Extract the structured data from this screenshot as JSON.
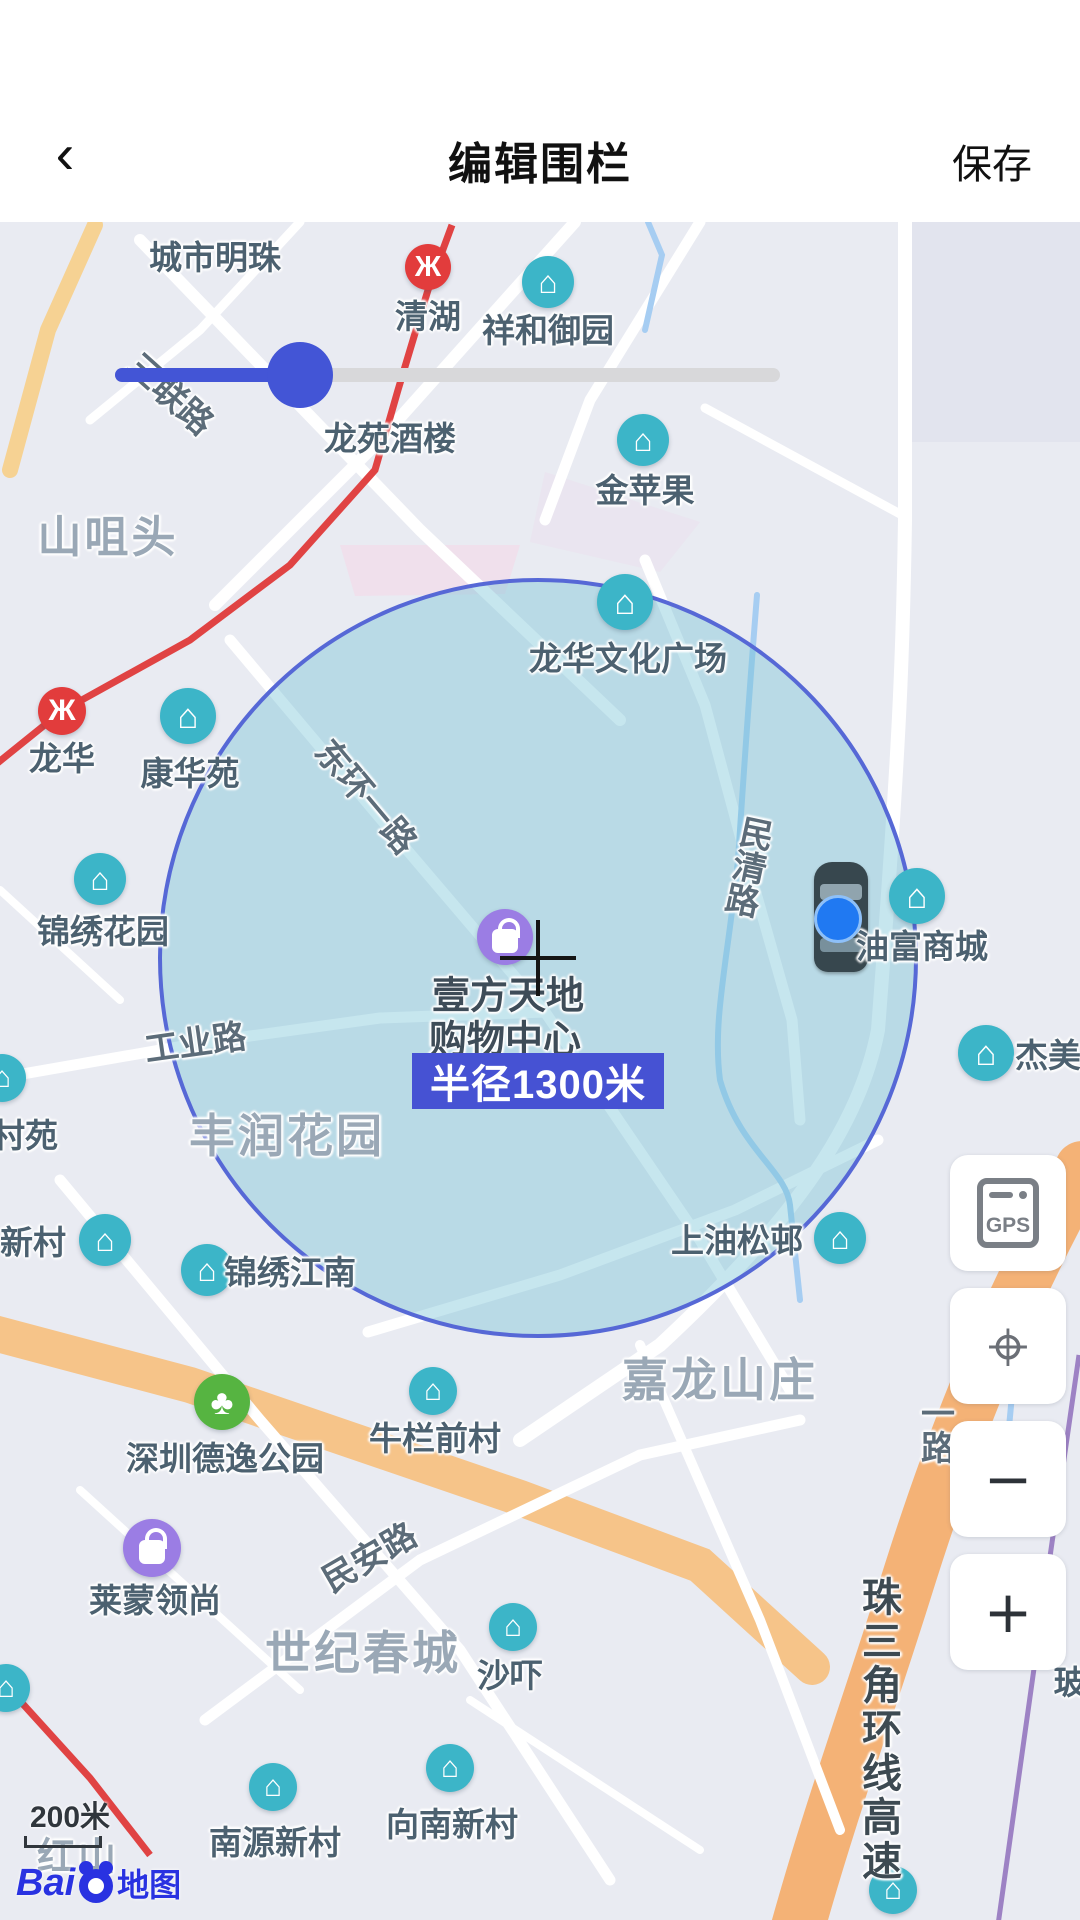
{
  "header": {
    "back_icon": "‹",
    "title": "编辑围栏",
    "save_label": "保存"
  },
  "map": {
    "radius_badge": "半径1300米",
    "scale_label": "200米",
    "attribution": {
      "latin": "Bai",
      "cn": "地图"
    },
    "accent_colors": {
      "slider_blue": "#4355d6",
      "badge_blue": "#4652d3",
      "circle_stroke": "#5668d6",
      "poi_teal": "#3cb5c8",
      "metro_red": "#e23c3c",
      "poi_purple": "#9b7de4",
      "park_green": "#56b441"
    },
    "labels": [
      {
        "text": "城市明珠",
        "x": 215,
        "y": 33,
        "kind": "poi"
      },
      {
        "text": "清湖",
        "x": 428,
        "y": 92,
        "kind": "poi"
      },
      {
        "text": "祥和御园",
        "x": 548,
        "y": 106,
        "kind": "poi"
      },
      {
        "text": "三联路",
        "x": 172,
        "y": 170,
        "kind": "road",
        "rot": 42
      },
      {
        "text": "龙苑酒楼",
        "x": 390,
        "y": 214,
        "kind": "poi"
      },
      {
        "text": "金苹果",
        "x": 645,
        "y": 266,
        "kind": "poi"
      },
      {
        "text": "山咀头",
        "x": 108,
        "y": 311,
        "kind": "area",
        "fs": 44
      },
      {
        "text": "龙华文化广场",
        "x": 628,
        "y": 434,
        "kind": "poi"
      },
      {
        "text": "龙华",
        "x": 62,
        "y": 534,
        "kind": "poi"
      },
      {
        "text": "康华苑",
        "x": 190,
        "y": 549,
        "kind": "poi"
      },
      {
        "text": "东环一路",
        "x": 368,
        "y": 573,
        "kind": "road",
        "rot": 50
      },
      {
        "text": "民清路",
        "x": 747,
        "y": 644,
        "kind": "road",
        "vert": true,
        "rot": 12
      },
      {
        "text": "锦绣花园",
        "x": 103,
        "y": 707,
        "kind": "poi"
      },
      {
        "text": "壹方天地",
        "x": 508,
        "y": 770,
        "kind": "poi-dark"
      },
      {
        "text": "购物中心",
        "x": 505,
        "y": 814,
        "kind": "poi-dark"
      },
      {
        "text": "油富商城",
        "x": 922,
        "y": 722,
        "kind": "poi"
      },
      {
        "text": "工业路",
        "x": 195,
        "y": 818,
        "kind": "road",
        "rot": -8
      },
      {
        "text": "杰美",
        "x": 1048,
        "y": 831,
        "kind": "poi"
      },
      {
        "text": "村苑",
        "x": 25,
        "y": 911,
        "kind": "poi"
      },
      {
        "text": "丰润花园",
        "x": 287,
        "y": 911,
        "kind": "area"
      },
      {
        "text": "上油松邨",
        "x": 737,
        "y": 1016,
        "kind": "poi"
      },
      {
        "text": "新村",
        "x": 33,
        "y": 1018,
        "kind": "poi"
      },
      {
        "text": "锦绣江南",
        "x": 290,
        "y": 1048,
        "kind": "poi"
      },
      {
        "text": "嘉龙山庄",
        "x": 720,
        "y": 1155,
        "kind": "area"
      },
      {
        "text": "一路",
        "x": 935,
        "y": 1208,
        "kind": "road",
        "vert": true
      },
      {
        "text": "牛栏前村",
        "x": 435,
        "y": 1214,
        "kind": "poi"
      },
      {
        "text": "深圳德逸公园",
        "x": 225,
        "y": 1234,
        "kind": "poi"
      },
      {
        "text": "民安路",
        "x": 368,
        "y": 1333,
        "kind": "road",
        "rot": -30
      },
      {
        "text": "莱蒙领尚",
        "x": 155,
        "y": 1376,
        "kind": "poi"
      },
      {
        "text": "世纪春城",
        "x": 363,
        "y": 1428,
        "kind": "area"
      },
      {
        "text": "沙吓",
        "x": 510,
        "y": 1451,
        "kind": "poi"
      },
      {
        "text": "玻",
        "x": 1070,
        "y": 1458,
        "kind": "poi"
      },
      {
        "text": "珠三角环线高速",
        "x": 878,
        "y": 1508,
        "kind": "road",
        "vert": true,
        "fs": 40,
        "dark": true
      },
      {
        "text": "向南新村",
        "x": 452,
        "y": 1600,
        "kind": "poi"
      },
      {
        "text": "南源新村",
        "x": 275,
        "y": 1618,
        "kind": "poi"
      },
      {
        "text": "红山",
        "x": 78,
        "y": 1631,
        "kind": "area",
        "fs": 38
      }
    ],
    "icons": [
      {
        "type": "metro",
        "x": 428,
        "y": 45,
        "size": 46
      },
      {
        "type": "building",
        "x": 548,
        "y": 60,
        "size": 52
      },
      {
        "type": "building",
        "x": 643,
        "y": 218,
        "size": 52
      },
      {
        "type": "building",
        "x": 625,
        "y": 380,
        "size": 56
      },
      {
        "type": "metro",
        "x": 62,
        "y": 489,
        "size": 48
      },
      {
        "type": "building",
        "x": 188,
        "y": 494,
        "size": 56
      },
      {
        "type": "building",
        "x": 100,
        "y": 657,
        "size": 52
      },
      {
        "type": "shop",
        "x": 505,
        "y": 715,
        "size": 56
      },
      {
        "type": "building",
        "x": 917,
        "y": 674,
        "size": 56
      },
      {
        "type": "building",
        "x": 986,
        "y": 831,
        "size": 56
      },
      {
        "type": "building",
        "x": 2,
        "y": 856,
        "size": 48
      },
      {
        "type": "building",
        "x": 840,
        "y": 1016,
        "size": 52
      },
      {
        "type": "building",
        "x": 105,
        "y": 1018,
        "size": 52
      },
      {
        "type": "building",
        "x": 207,
        "y": 1048,
        "size": 52
      },
      {
        "type": "building",
        "x": 433,
        "y": 1169,
        "size": 48
      },
      {
        "type": "park",
        "x": 222,
        "y": 1180,
        "size": 56
      },
      {
        "type": "shop",
        "x": 152,
        "y": 1326,
        "size": 58
      },
      {
        "type": "building",
        "x": 513,
        "y": 1405,
        "size": 48
      },
      {
        "type": "building",
        "x": 6,
        "y": 1466,
        "size": 48
      },
      {
        "type": "building",
        "x": 450,
        "y": 1546,
        "size": 48
      },
      {
        "type": "building",
        "x": 273,
        "y": 1565,
        "size": 48
      },
      {
        "type": "building",
        "x": 893,
        "y": 1668,
        "size": 48
      }
    ],
    "controls": [
      {
        "id": "gps",
        "label": "GPS"
      },
      {
        "id": "locate",
        "glyph": "⌖"
      },
      {
        "id": "zoom-out",
        "glyph": "−"
      },
      {
        "id": "zoom-in",
        "glyph": "+"
      }
    ]
  }
}
